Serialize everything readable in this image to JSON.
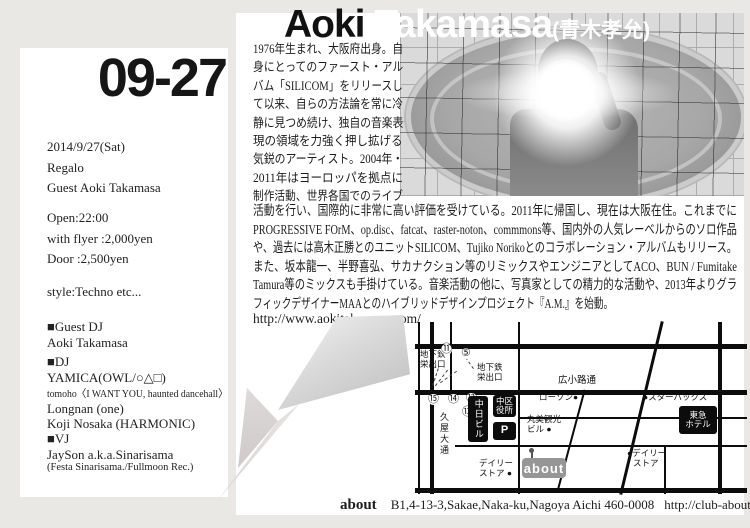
{
  "event": {
    "date_display": "09-27",
    "date_full": "2014/9/27(Sat)",
    "venue": "Regalo",
    "guest": "Guest Aoki Takamasa",
    "open": "Open:22:00",
    "price_flyer": "with flyer :2,000yen",
    "price_door": "Door :2,500yen",
    "style": "style:Techno etc..."
  },
  "lineup": {
    "guest_dj_heading": "■Guest DJ",
    "guest_dj": "Aoki Takamasa",
    "dj_heading": "■DJ",
    "dj_1": "YAMICA(OWL/○△□)",
    "dj_2": "tomoho〈I WANT YOU, haunted dancehall〉",
    "dj_3": "Longnan (one)",
    "dj_4": "Koji Nosaka (HARMONIC)",
    "vj_heading": "■VJ",
    "vj_1": "JaySon a.k.a.Sinarisama",
    "vj_2": "(Festa Sinarisama./Fullmoon Rec.)"
  },
  "artist": {
    "first_name": "Aoki",
    "last_name": "Takamasa",
    "kanji": "(青木孝允)",
    "bio_col_lines": [
      "1976年生まれ、大阪府出身。自",
      "身にとってのファースト・アル",
      "バム「SILICOM」をリリースし",
      "て以来、自らの方法論を常に冷",
      "静に見つめ続け、独自の音楽表",
      "現の領域を力強く押し拡げる",
      "気鋭のアーティスト。2004年・",
      "2011年はヨーロッパを拠点に",
      "制作活動、世界各国でのライブ"
    ],
    "bio_wide_lines": [
      "活動を行い、国際的に非常に高い評価を受けている。2011年に帰国し、現在は大阪在住。これまでに",
      "PROGRESSIVE FOrM、op.disc、fatcat、raster-noton、commmons等、国内外の人気レーベルからのソロ作品",
      "や、過去には高木正勝とのユニットSILICOM、Tujiko Norikoとのコラボレーション・アルバムもリリース。",
      "また、坂本龍一、半野喜弘、サカナクション等のリミックスやエンジニアとしてACO、BUN / Fumitake",
      "Tamura等のミックスも手掛けている。音楽活動の他に、写真家としての精力的な活動や、2013年よりグラ"
    ],
    "bio_tail_line": "フィックデザイナーMAAとのハイブリッドデザインプロジェクト『A.M.』を始動。",
    "website": "http://www.aokitakamasa.com/"
  },
  "map": {
    "street_horizontal": "広小路通",
    "street_vertical": "久屋大通",
    "exit1_line1": "地下鉄",
    "exit1_line2": "栄出口",
    "exit2_line1": "地下鉄",
    "exit2_line2": "栄出口",
    "num_11": "⑪",
    "num_5": "⑤",
    "num_15": "⑮",
    "num_14": "⑭",
    "num_12": "⑫",
    "num_13": "⑬",
    "bldg_chunichi": "中日ビル",
    "bldg_ward_1": "中区",
    "bldg_ward_2": "役所",
    "bldg_parking": "P",
    "bldg_tokyu_1": "東急",
    "bldg_tokyu_2": "ホテル",
    "poi_lawson": "ローソン●",
    "poi_starbucks": "●スターバックス",
    "poi_marumi_1": "丸美観光",
    "poi_marumi_2": "ビル ●",
    "poi_daily1_1": "デイリー",
    "poi_daily1_2": "ストア ●",
    "poi_daily2_1": "●デイリー",
    "poi_daily2_2": "ストア",
    "venue_logo": "about"
  },
  "footer": {
    "venue": "about",
    "address": "B1,4-13-3,Sakae,Naka-ku,Nagoya Aichi 460-0008",
    "url": "http://club-about.com"
  }
}
